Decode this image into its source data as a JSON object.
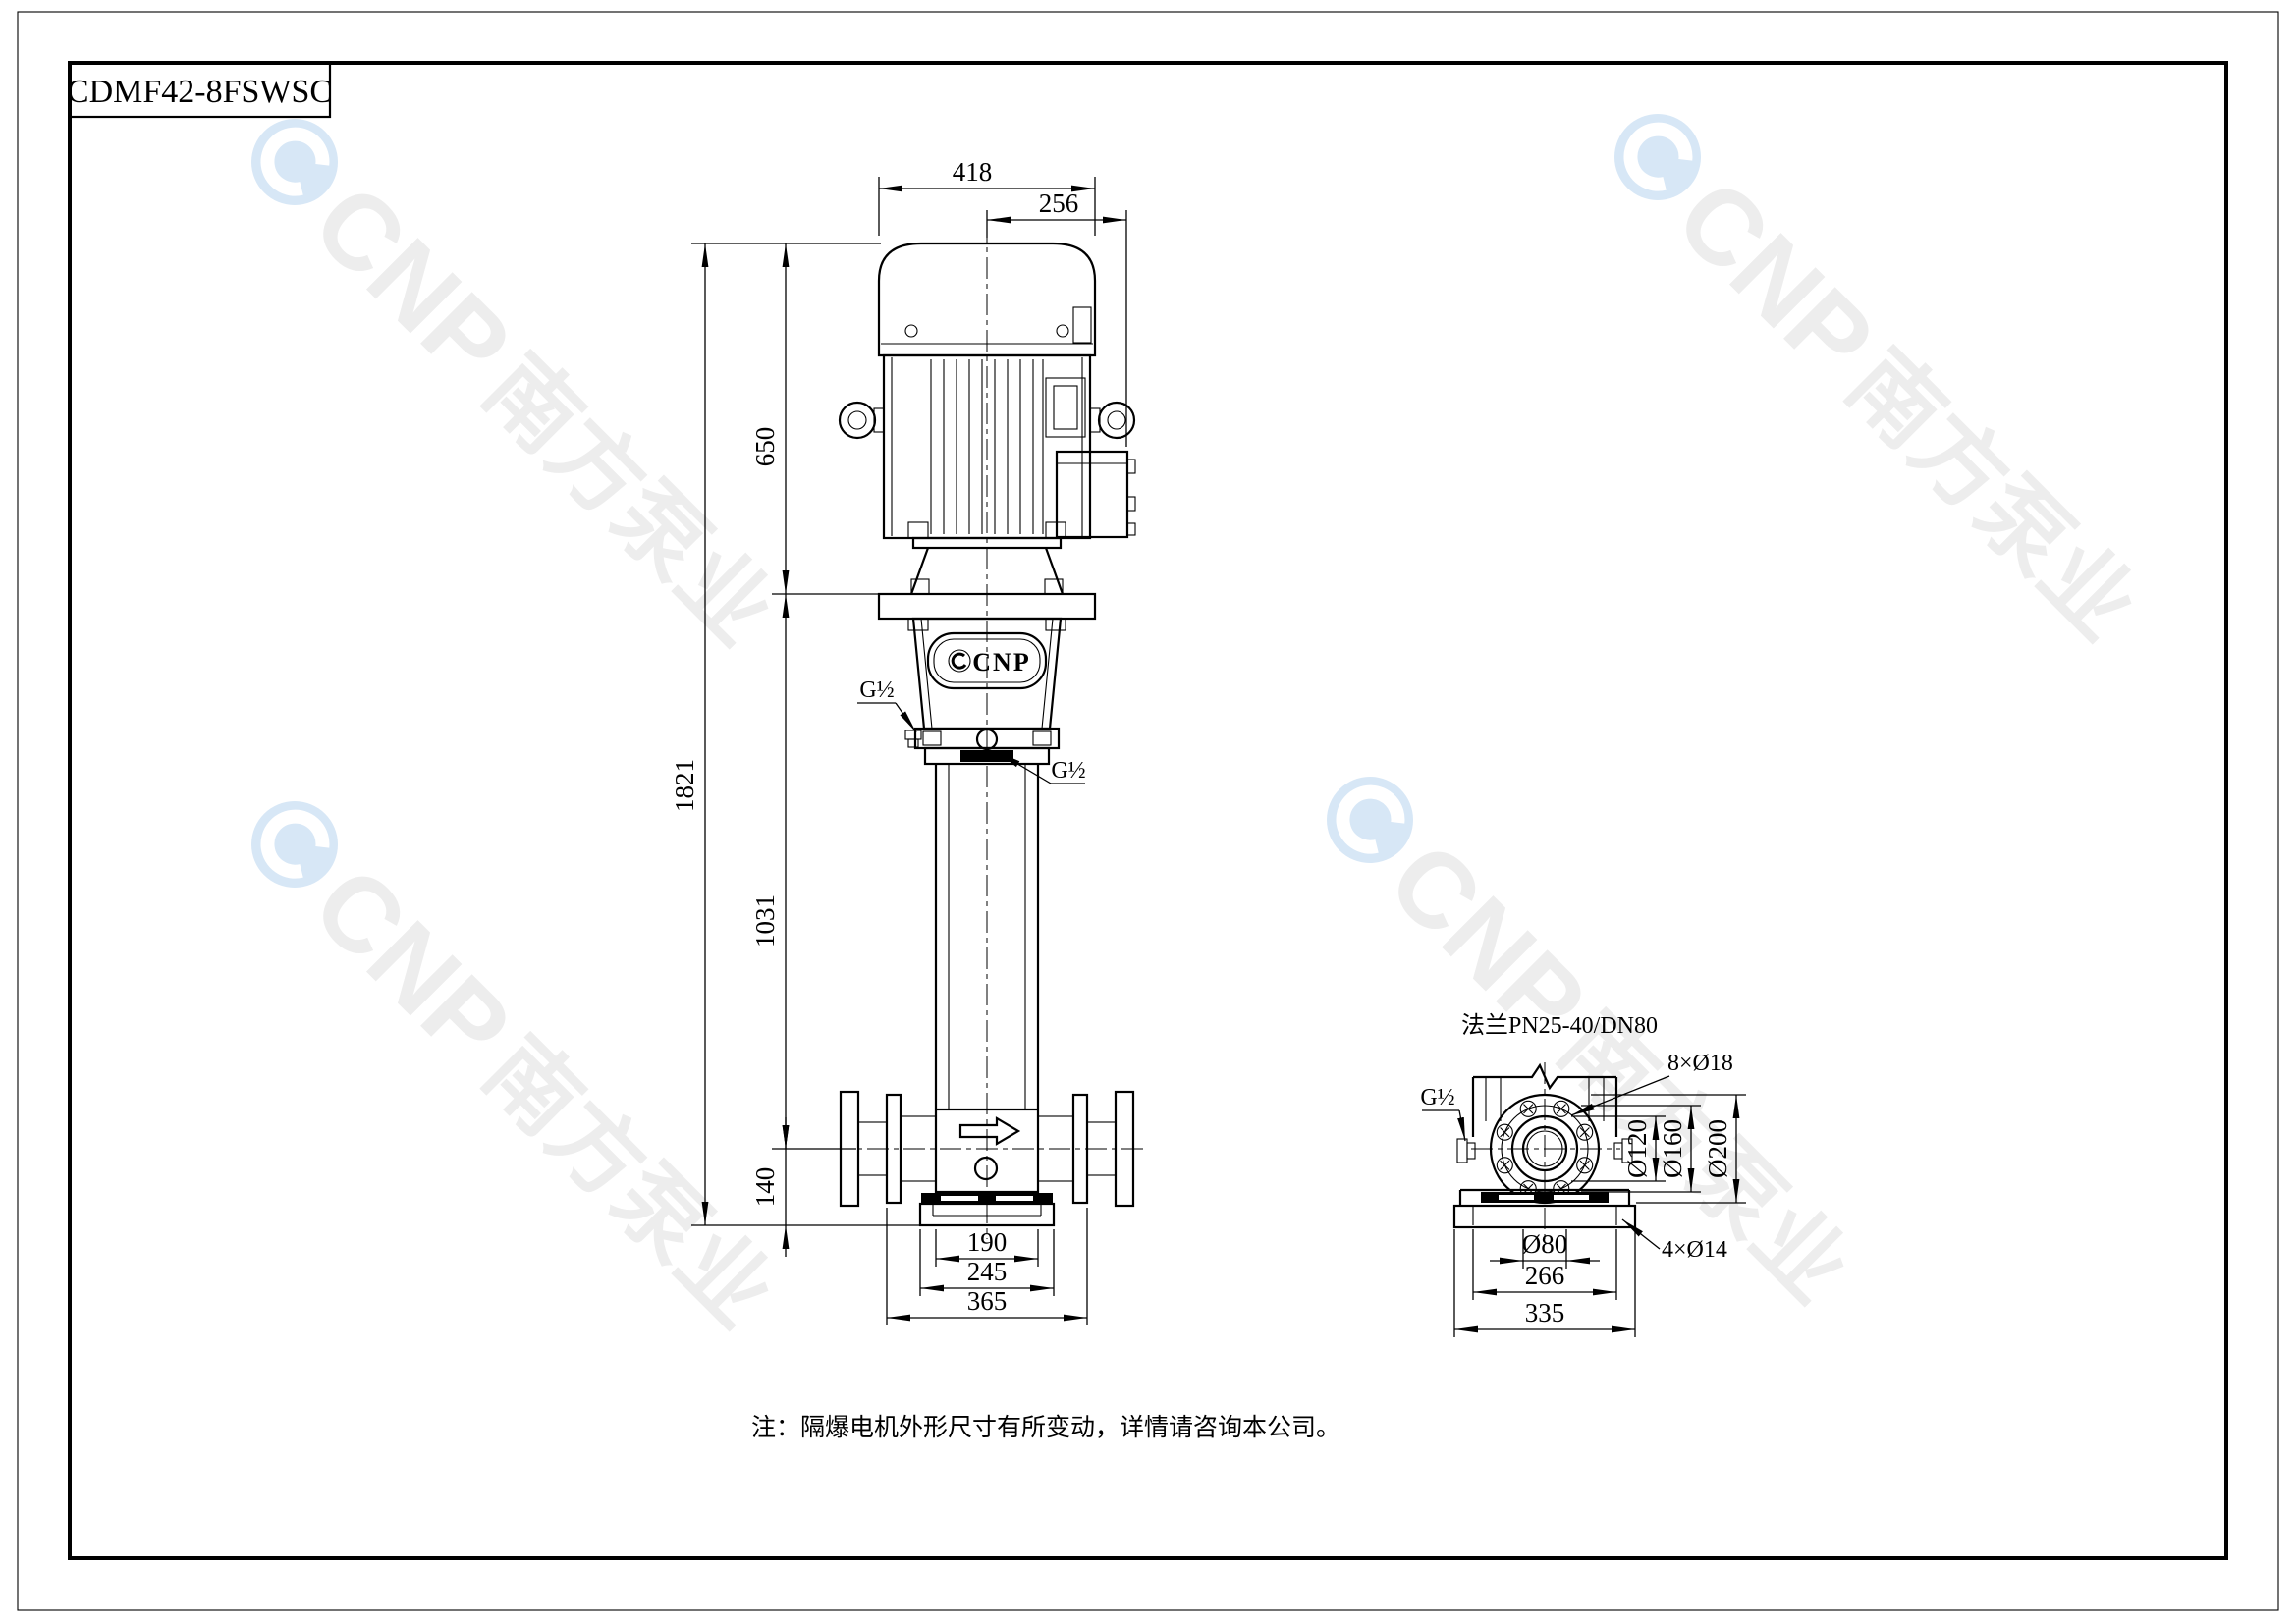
{
  "sheet": {
    "model": "CDMF42-8FSWSC",
    "note": "注：隔爆电机外形尺寸有所变动，详情请咨询本公司。"
  },
  "front_view": {
    "badge_text": "CNP",
    "port_top": "G½",
    "port_mid": "G½",
    "dims": {
      "top_width": "418",
      "terminal_width": "256",
      "motor_height": "650",
      "total_height": "1821",
      "pump_height": "1031",
      "base_height": "140",
      "stack_width": "190",
      "foot_width": "245",
      "flange_span": "365"
    }
  },
  "detail_view": {
    "title": "法兰PN25-40/DN80",
    "bolt_holes": "8×Ø18",
    "foot_holes": "4×Ø14",
    "port": "G½",
    "dims": {
      "hub": "Ø120",
      "bolt_circle": "Ø160",
      "outer": "Ø200",
      "bore": "Ø80",
      "slot_span": "266",
      "foot_width": "335"
    }
  },
  "watermark": {
    "brand": "CNP",
    "brand_cn": "南方泵业"
  },
  "colors": {
    "line": "#000000",
    "watermark_blue": "#d7e7f6",
    "watermark_gray": "#ededed"
  }
}
